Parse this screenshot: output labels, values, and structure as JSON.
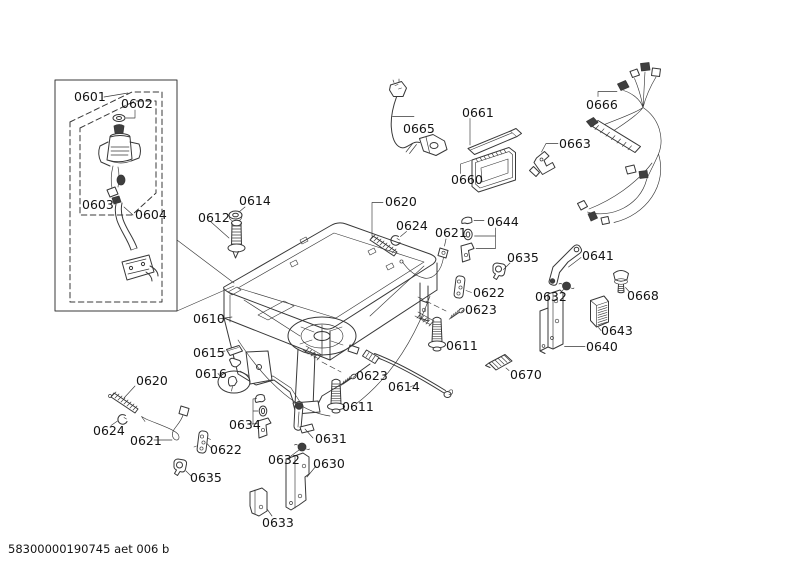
{
  "page": {
    "background": "#ffffff",
    "line_color": "#383838",
    "text_color": "#141414"
  },
  "diagram": {
    "type": "exploded-parts-diagram",
    "footer": "58300000190745 aet 006 b",
    "labels": {
      "L0601": "0601",
      "L0602": "0602",
      "L0603": "0603",
      "L0604": "0604",
      "L0610": "0610",
      "L0611A": "0611",
      "L0611B": "0611",
      "L0612": "0612",
      "L0614A": "0614",
      "L0614B": "0614",
      "L0615": "0615",
      "L0616": "0616",
      "L0620A": "0620",
      "L0620B": "0620",
      "L0621A": "0621",
      "L0621B": "0621",
      "L0622A": "0622",
      "L0622B": "0622",
      "L0623A": "0623",
      "L0623B": "0623",
      "L0624A": "0624",
      "L0624B": "0624",
      "L0630": "0630",
      "L0631": "0631",
      "L0632A": "0632",
      "L0632B": "0632",
      "L0633": "0633",
      "L0634": "0634",
      "L0635A": "0635",
      "L0635B": "0635",
      "L0640": "0640",
      "L0641": "0641",
      "L0643": "0643",
      "L0644": "0644",
      "L0660": "0660",
      "L0661": "0661",
      "L0663": "0663",
      "L0665": "0665",
      "L0666": "0666",
      "L0668": "0668",
      "L0670": "0670"
    }
  }
}
